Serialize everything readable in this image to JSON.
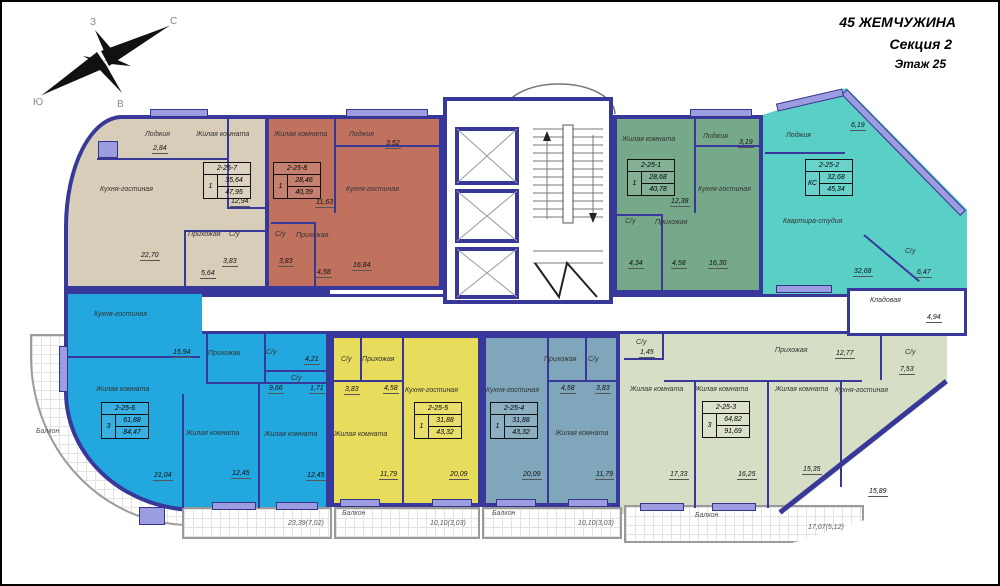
{
  "header": {
    "building": "45 ЖЕМЧУЖИНА",
    "section": "Секция 2",
    "floor": "Этаж 25"
  },
  "compass": {
    "north": "С",
    "south": "Ю",
    "west": "З",
    "east": "В"
  },
  "colors": {
    "wall": "#38389a",
    "window": "#9c9ce0",
    "corridor": "#ffffff"
  },
  "apartments": [
    {
      "id": "2-25-7",
      "type": "1",
      "living": "35,64",
      "total": "47,95",
      "color": "#d8cdb9",
      "rooms": [
        {
          "name": "Лоджия",
          "area": "2,84"
        },
        {
          "name": "Жилая комната",
          "area": "12,94"
        },
        {
          "name": "Кухня-гостиная",
          "area": "22,70"
        },
        {
          "name": "Прихожая",
          "area": "5,64"
        },
        {
          "name": "С/у",
          "area": "3,83"
        }
      ]
    },
    {
      "id": "2-25-8",
      "type": "1",
      "living": "28,46",
      "total": "40,39",
      "color": "#c0725f",
      "rooms": [
        {
          "name": "Жилая комната",
          "area": "11,63"
        },
        {
          "name": "Лоджия",
          "area": "3,52"
        },
        {
          "name": "Кухня-гостиная",
          "area": "16,84"
        },
        {
          "name": "С/у",
          "area": "3,83"
        },
        {
          "name": "Прихожая",
          "area": "4,58"
        }
      ]
    },
    {
      "id": "2-25-1",
      "type": "1",
      "living": "28,68",
      "total": "40,78",
      "color": "#76a98a",
      "rooms": [
        {
          "name": "Жилая комната",
          "area": "12,38"
        },
        {
          "name": "Лоджия",
          "area": "3,19"
        },
        {
          "name": "Кухня-гостиная",
          "area": "16,30"
        },
        {
          "name": "С/у",
          "area": "4,34"
        },
        {
          "name": "Прихожая",
          "area": "4,58"
        }
      ]
    },
    {
      "id": "2-25-2",
      "type": "КС",
      "living": "32,68",
      "total": "45,34",
      "color": "#59cfc6",
      "rooms": [
        {
          "name": "Лоджия",
          "area": "6,19"
        },
        {
          "name": "Квартира-студия",
          "area": "32,68"
        },
        {
          "name": "С/у",
          "area": "6,47"
        }
      ]
    },
    {
      "id": "2-25-6",
      "type": "3",
      "living": "61,88",
      "total": "84,47",
      "color": "#22a7de",
      "rooms": [
        {
          "name": "Кухня-гостиная",
          "area": "15,94"
        },
        {
          "name": "Прихожая",
          "area": "9,66"
        },
        {
          "name": "С/у",
          "area": "4,21"
        },
        {
          "name": "С/у",
          "area": "1,71"
        },
        {
          "name": "Жилая комната",
          "area": "21,04"
        },
        {
          "name": "Жилая комната",
          "area": "12,45"
        },
        {
          "name": "Жилая комната",
          "area": "12,45"
        }
      ]
    },
    {
      "id": "2-25-5",
      "type": "1",
      "living": "31,88",
      "total": "43,32",
      "color": "#e8dc5d",
      "rooms": [
        {
          "name": "С/у",
          "area": "3,83"
        },
        {
          "name": "Прихожая",
          "area": "4,58"
        },
        {
          "name": "Кухня-гостиная",
          "area": "20,09"
        },
        {
          "name": "Жилая комната",
          "area": "11,79"
        }
      ]
    },
    {
      "id": "2-25-4",
      "type": "1",
      "living": "31,88",
      "total": "43,32",
      "color": "#7fa6bb",
      "rooms": [
        {
          "name": "Прихожая",
          "area": "4,58"
        },
        {
          "name": "С/у",
          "area": "3,83"
        },
        {
          "name": "Кухня-гостиная",
          "area": "20,09"
        },
        {
          "name": "Жилая комната",
          "area": "11,79"
        }
      ]
    },
    {
      "id": "2-25-3",
      "type": "3",
      "living": "64,82",
      "total": "91,69",
      "color": "#d6dfc6",
      "rooms": [
        {
          "name": "С/у",
          "area": "1,45"
        },
        {
          "name": "Жилая комната",
          "area": "17,33"
        },
        {
          "name": "Жилая комната",
          "area": "16,25"
        },
        {
          "name": "Прихожая",
          "area": "12,77"
        },
        {
          "name": "Жилая комната",
          "area": "15,35"
        },
        {
          "name": "Кухня-гостиная",
          "area": "15,89"
        },
        {
          "name": "С/у",
          "area": "7,53"
        }
      ]
    }
  ],
  "storage": {
    "label": "Кладовая",
    "area": "4,94"
  },
  "balconies": {
    "left_label": "Балкон",
    "a_value": "23,39(7,02)",
    "b_label": "Балкон",
    "b_value": "10,10(3,03)",
    "c_label": "Балкон",
    "c_value": "10,10(3,03)",
    "d_label": "Балкон",
    "d_value": "17,07(5,12)"
  }
}
